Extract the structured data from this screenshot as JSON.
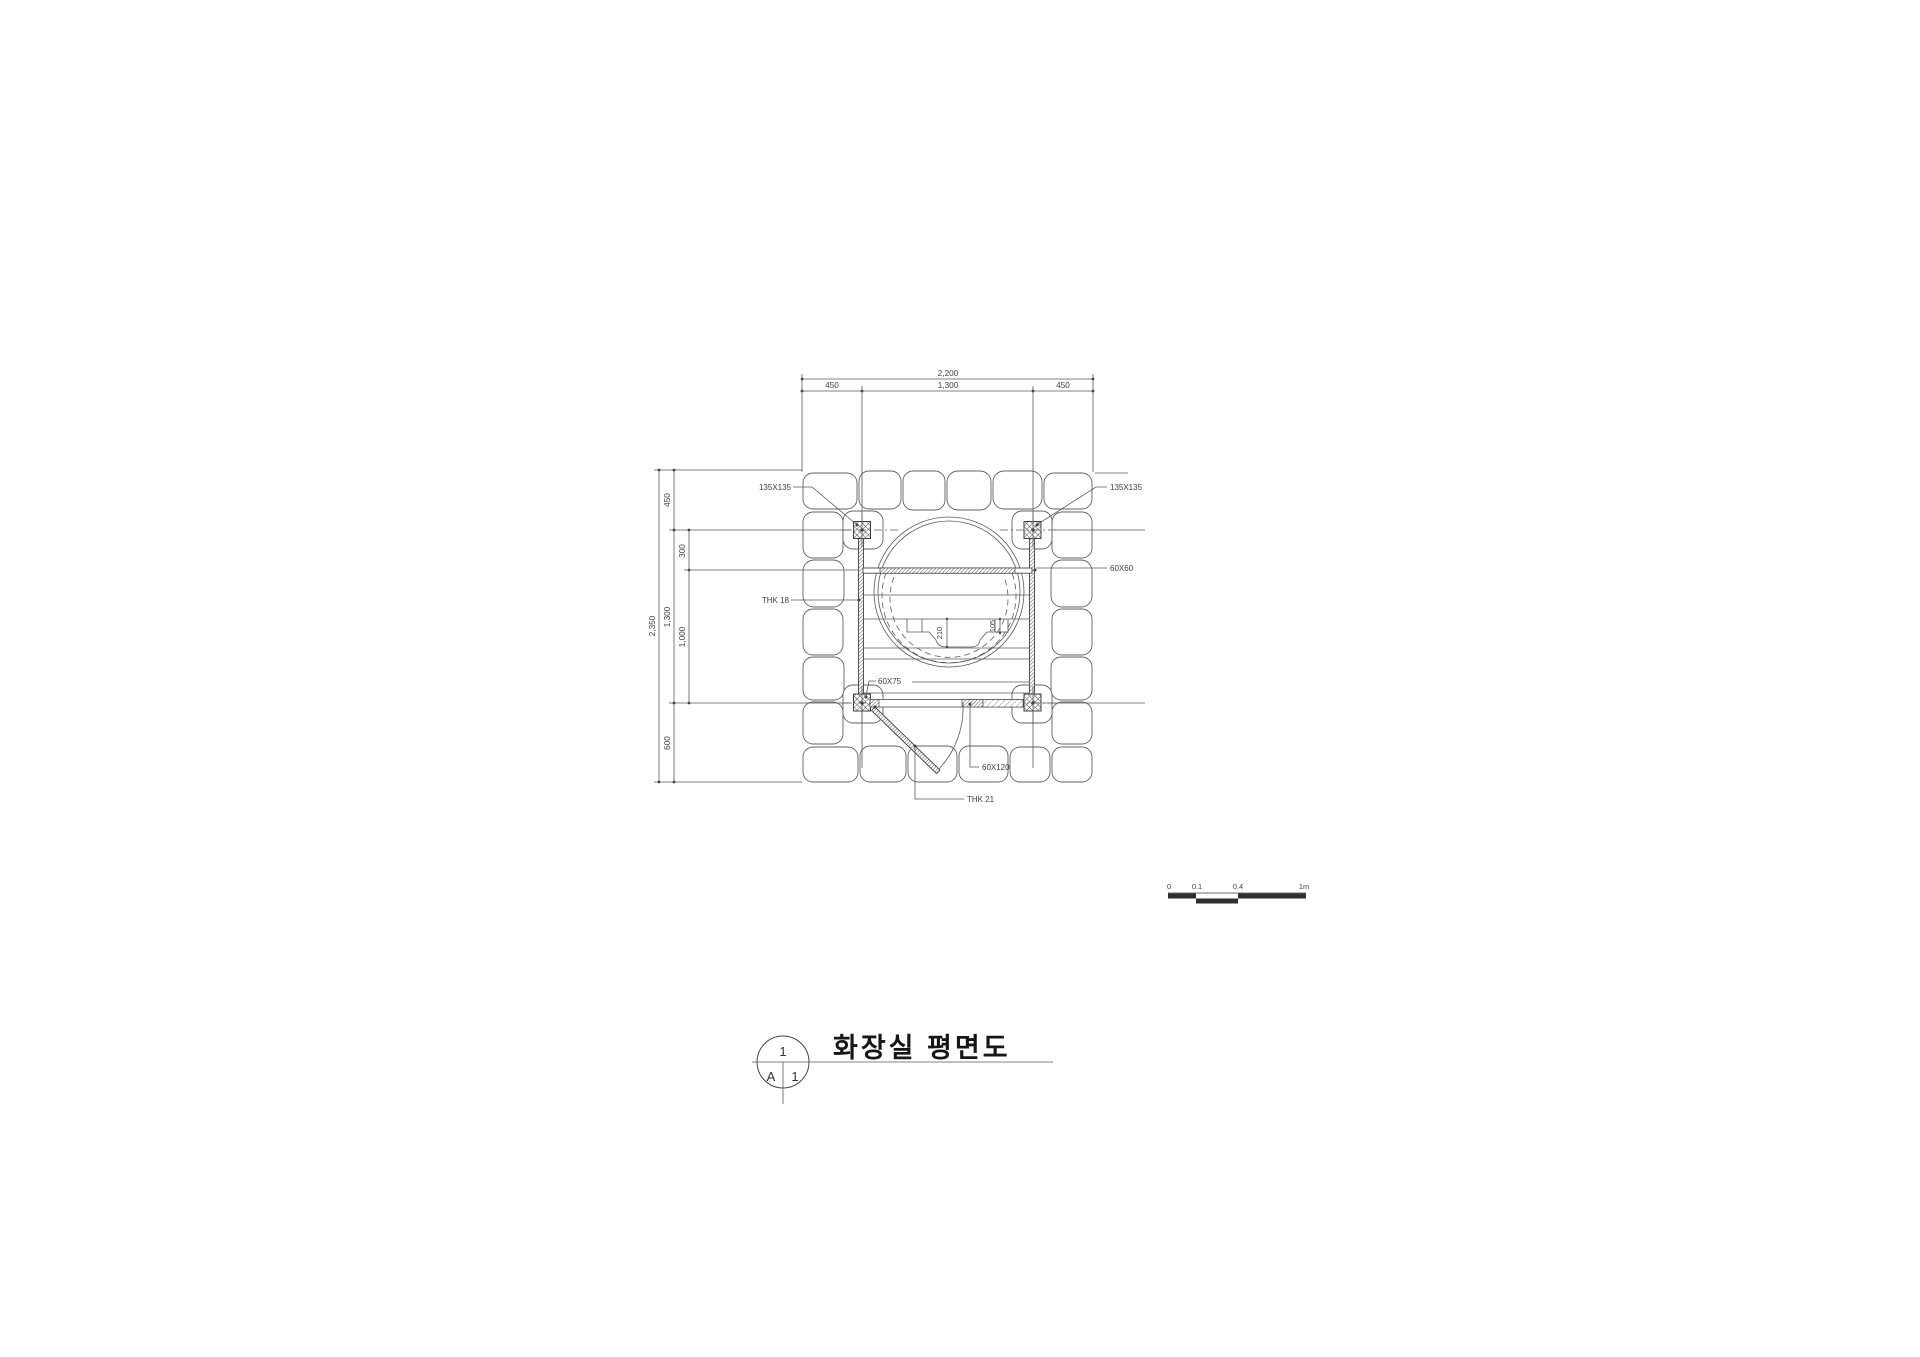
{
  "drawing": {
    "title": "화장실 평면도",
    "callout": {
      "number": "1",
      "grid_col": "A",
      "grid_row": "1"
    },
    "dims_top": {
      "total": "2,200",
      "segments": [
        "450",
        "1,300",
        "450"
      ]
    },
    "dims_left": {
      "total": "2,350",
      "segments": [
        "450",
        "1,300",
        "600"
      ],
      "inner": [
        "300",
        "1,000"
      ]
    },
    "dims_center": {
      "pit_depth": "210",
      "step_offset": "105"
    },
    "labels": {
      "post_left": "135X135",
      "post_right": "135X135",
      "beam": "60X60",
      "wall": "THK 18",
      "joist": "60X75",
      "threshold": "60X120",
      "door": "THK 21"
    },
    "scale": {
      "ticks": [
        "0",
        "0.1",
        "0.4",
        "1m"
      ]
    },
    "colors": {
      "line": "#555555",
      "text": "#3f3f3f",
      "scale_block": "#2e2e2e"
    }
  }
}
